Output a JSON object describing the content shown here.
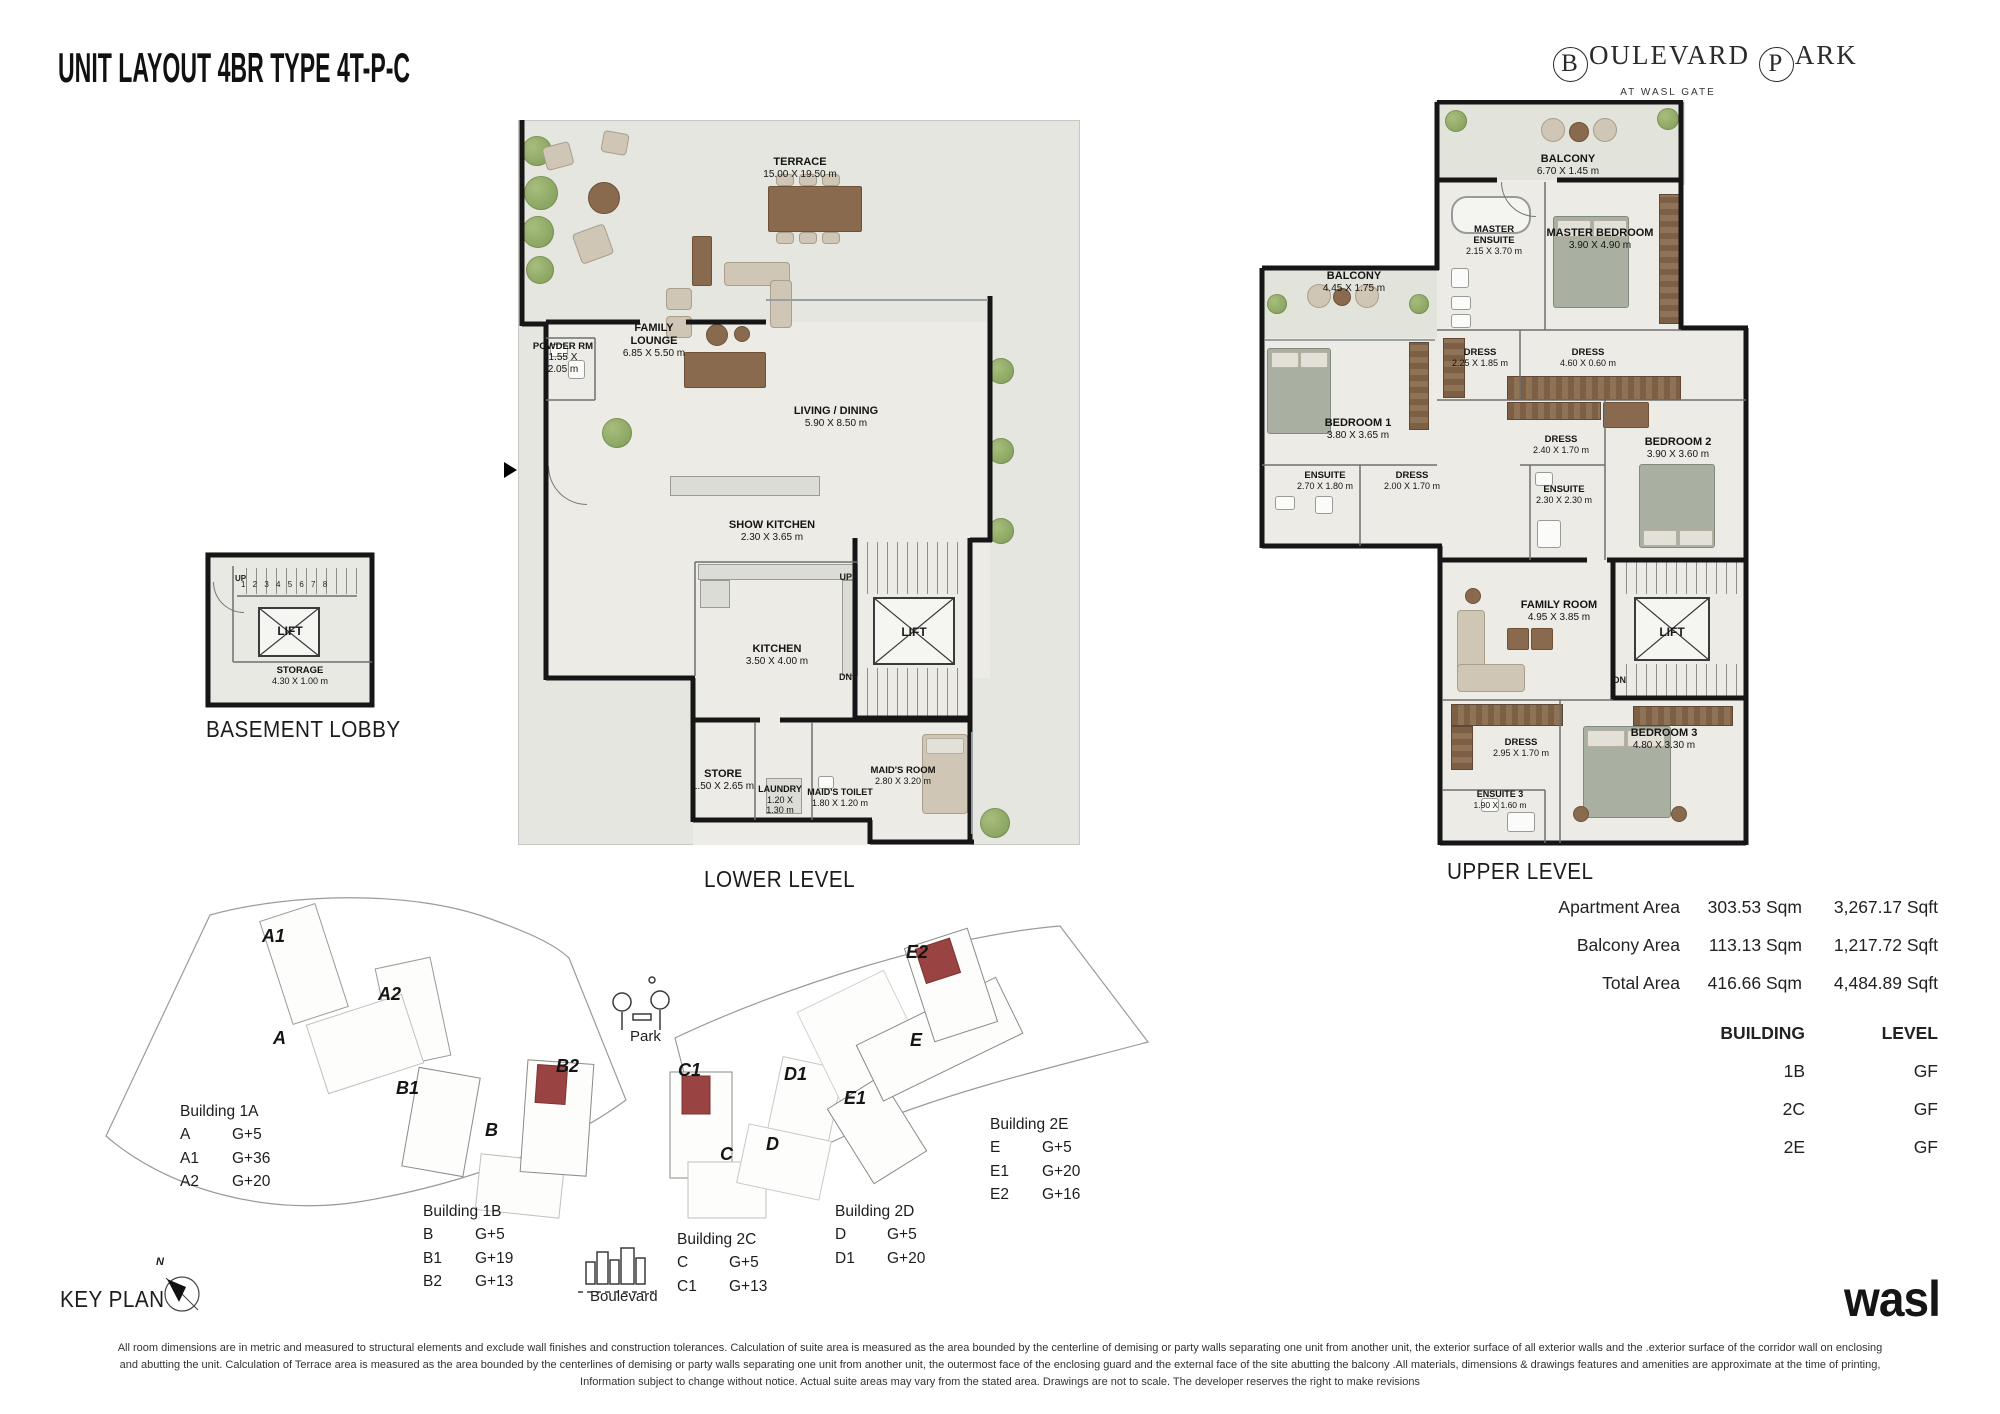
{
  "header": {
    "title": "UNIT LAYOUT 4BR TYPE 4T-P-C"
  },
  "brand": {
    "initial_b": "B",
    "word_b": "OULEVARD",
    "initial_p": "P",
    "word_p": "ARK",
    "subtitle": "AT WASL GATE"
  },
  "labels": {
    "lift": "LIFT",
    "up": "UP",
    "dn": "DN",
    "north": "N",
    "basement_stairs": "1 2 3 4 5 6 7 8"
  },
  "colors": {
    "highlight_red": "#9a4343",
    "wall_black": "#161616",
    "floor_gray": "#e5e6df"
  },
  "plans": {
    "lower": {
      "caption": "LOWER LEVEL",
      "rooms": {
        "terrace": {
          "name": "TERRACE",
          "dims": "15.00 X 19.50 m"
        },
        "family_lounge": {
          "name": "FAMILY LOUNGE",
          "dims": "6.85 X 5.50 m"
        },
        "powder": {
          "name": "POWDER RM",
          "dims": "1.55 X 2.05 m"
        },
        "living_dining": {
          "name": "LIVING / DINING",
          "dims": "5.90 X 8.50 m"
        },
        "show_kitchen": {
          "name": "SHOW KITCHEN",
          "dims": "2.30 X 3.65 m"
        },
        "kitchen": {
          "name": "KITCHEN",
          "dims": "3.50 X 4.00 m"
        },
        "store": {
          "name": "STORE",
          "dims": "1.50 X 2.65 m"
        },
        "laundry": {
          "name": "LAUNDRY",
          "dims": "1.20 X 1.30 m"
        },
        "maids_toilet": {
          "name": "MAID'S TOILET",
          "dims": "1.80 X 1.20 m"
        },
        "maids_room": {
          "name": "MAID'S ROOM",
          "dims": "2.80 X 3.20 m"
        }
      }
    },
    "upper": {
      "caption": "UPPER LEVEL",
      "rooms": {
        "balcony_top": {
          "name": "BALCONY",
          "dims": "6.70 X 1.45 m"
        },
        "master_ensuite": {
          "name": "MASTER ENSUITE",
          "dims": "2.15 X 3.70 m"
        },
        "master_bedroom": {
          "name": "MASTER BEDROOM",
          "dims": "3.90 X 4.90 m"
        },
        "balcony_left": {
          "name": "BALCONY",
          "dims": "4.45 X 1.75 m"
        },
        "bedroom1": {
          "name": "BEDROOM 1",
          "dims": "3.80 X 3.65 m"
        },
        "dress_225": {
          "name": "DRESS",
          "dims": "2.25 X 1.85 m"
        },
        "dress_460": {
          "name": "DRESS",
          "dims": "4.60 X 0.60 m"
        },
        "dress_240": {
          "name": "DRESS",
          "dims": "2.40 X 1.70 m"
        },
        "dress_200": {
          "name": "DRESS",
          "dims": "2.00 X 1.70 m"
        },
        "dress_295": {
          "name": "DRESS",
          "dims": "2.95 X 1.70 m"
        },
        "ensuite1": {
          "name": "ENSUITE",
          "dims": "2.70 X 1.80 m"
        },
        "ensuite2": {
          "name": "ENSUITE",
          "dims": "2.30 X 2.30 m"
        },
        "ensuite3": {
          "name": "ENSUITE 3",
          "dims": "1.90 X 1.60 m"
        },
        "bedroom2": {
          "name": "BEDROOM 2",
          "dims": "3.90 X 3.60 m"
        },
        "bedroom3": {
          "name": "BEDROOM 3",
          "dims": "4.80 X 3.30 m"
        },
        "family_room": {
          "name": "FAMILY ROOM",
          "dims": "4.95 X 3.85 m"
        }
      }
    },
    "basement": {
      "caption": "BASEMENT LOBBY",
      "rooms": {
        "storage": {
          "name": "STORAGE",
          "dims": "4.30 X 1.00 m"
        }
      }
    }
  },
  "areas": {
    "rows": [
      {
        "label": "Apartment Area",
        "sqm": "303.53 Sqm",
        "sqft": "3,267.17 Sqft"
      },
      {
        "label": "Balcony Area",
        "sqm": "113.13 Sqm",
        "sqft": "1,217.72 Sqft"
      },
      {
        "label": "Total Area",
        "sqm": "416.66 Sqm",
        "sqft": "4,484.89 Sqft"
      }
    ]
  },
  "building_table": {
    "col_building": "BUILDING",
    "col_level": "LEVEL",
    "rows": [
      {
        "building": "1B",
        "level": "GF"
      },
      {
        "building": "2C",
        "level": "GF"
      },
      {
        "building": "2E",
        "level": "GF"
      }
    ]
  },
  "keyplan": {
    "title": "KEY PLAN",
    "park": "Park",
    "boulevard": "Boulevard",
    "markers": {
      "a1": "A1",
      "a2": "A2",
      "a": "A",
      "b1": "B1",
      "b2": "B2",
      "b": "B",
      "c1": "C1",
      "c": "C",
      "d1": "D1",
      "d": "D",
      "e1": "E1",
      "e": "E",
      "e2": "E2"
    },
    "groups": [
      {
        "title": "Building 1A",
        "rows": [
          {
            "k": "A",
            "v": "G+5"
          },
          {
            "k": "A1",
            "v": "G+36"
          },
          {
            "k": "A2",
            "v": "G+20"
          }
        ]
      },
      {
        "title": "Building 1B",
        "rows": [
          {
            "k": "B",
            "v": "G+5"
          },
          {
            "k": "B1",
            "v": "G+19"
          },
          {
            "k": "B2",
            "v": "G+13"
          }
        ]
      },
      {
        "title": "Building 2C",
        "rows": [
          {
            "k": "C",
            "v": "G+5"
          },
          {
            "k": "C1",
            "v": "G+13"
          }
        ]
      },
      {
        "title": "Building 2D",
        "rows": [
          {
            "k": "D",
            "v": "G+5"
          },
          {
            "k": "D1",
            "v": "G+20"
          }
        ]
      },
      {
        "title": "Building 2E",
        "rows": [
          {
            "k": "E",
            "v": "G+5"
          },
          {
            "k": "E1",
            "v": "G+20"
          },
          {
            "k": "E2",
            "v": "G+16"
          }
        ]
      }
    ]
  },
  "footer": {
    "logo": "wasl",
    "disclaimer_line1": "All room dimensions are in metric and measured to structural elements and exclude wall finishes and construction tolerances. Calculation of suite area is measured as the area bounded by the centerline of demising or party walls separating one unit from another unit, the exterior surface of all exterior walls and the .exterior surface of the corridor wall on enclosing",
    "disclaimer_line2": "and abutting the unit. Calculation of Terrace area is measured as the area bounded by the centerlines of demising or party walls separating one unit from another unit, the outermost face of the enclosing guard and the external face of the site abutting the balcony .All materials, dimensions & drawings features and amenities are approximate at the time of printing,",
    "disclaimer_line3": "Information subject to change without notice. Actual suite areas may vary from the stated area. Drawings are not to scale. The developer reserves the right to make revisions"
  }
}
